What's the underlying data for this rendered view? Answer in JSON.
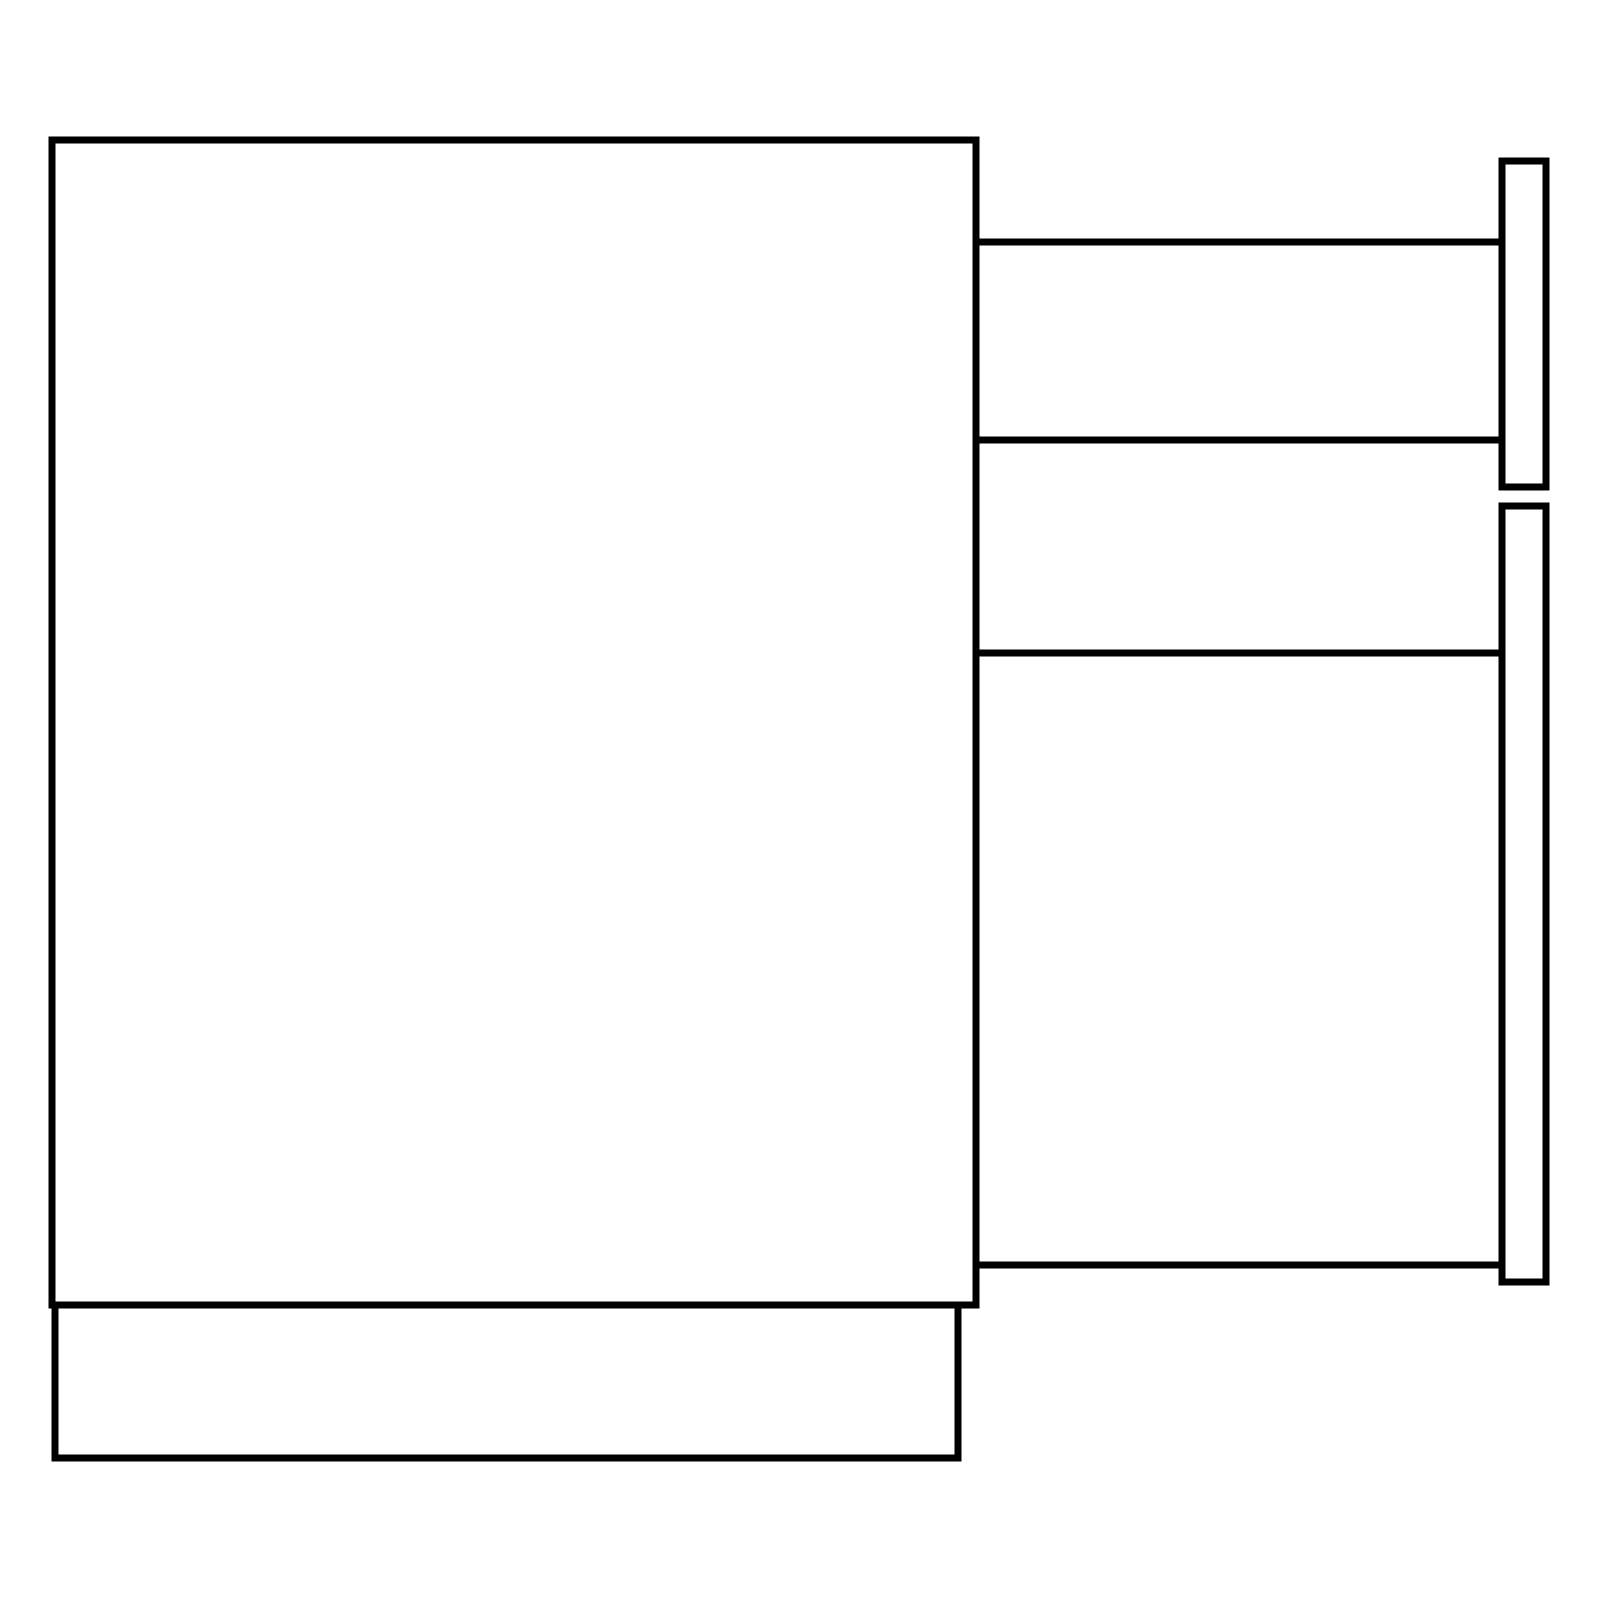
{
  "canvas": {
    "width": 1600,
    "height": 1600,
    "background_color": "#ffffff",
    "stroke_color": "#000000",
    "stroke_width": 7
  },
  "diagram": {
    "description": "Line drawing of a cabinet side view with base plinth and two extended drawers (rails and front panels)",
    "shapes": [
      {
        "id": "cabinet-body-outline",
        "type": "rect",
        "x1": 52,
        "y1": 140,
        "x2": 976,
        "y2": 1305
      },
      {
        "id": "cabinet-base-outline",
        "type": "rect",
        "x1": 55,
        "y1": 1305,
        "x2": 958,
        "y2": 1458
      },
      {
        "id": "drawer1-top-rail",
        "type": "line",
        "x1": 976,
        "y1": 242,
        "x2": 1502,
        "y2": 242
      },
      {
        "id": "drawer1-bottom-rail",
        "type": "line",
        "x1": 976,
        "y1": 440,
        "x2": 1502,
        "y2": 440
      },
      {
        "id": "drawer1-front-panel",
        "type": "rect",
        "x1": 1502,
        "y1": 161,
        "x2": 1546,
        "y2": 487
      },
      {
        "id": "drawer2-top-rail",
        "type": "line",
        "x1": 976,
        "y1": 653,
        "x2": 1502,
        "y2": 653
      },
      {
        "id": "drawer2-bottom-rail",
        "type": "line",
        "x1": 976,
        "y1": 1265,
        "x2": 1502,
        "y2": 1265
      },
      {
        "id": "drawer2-front-panel",
        "type": "rect",
        "x1": 1502,
        "y1": 506,
        "x2": 1546,
        "y2": 1282
      }
    ]
  }
}
